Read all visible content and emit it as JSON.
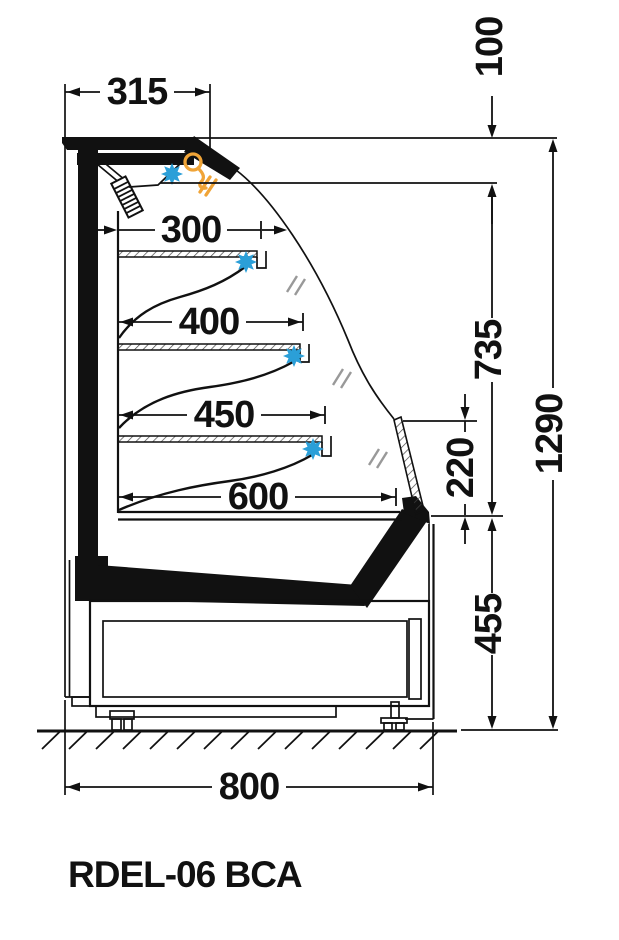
{
  "title": "RDEL-06 BCA",
  "drawing": {
    "type": "refrigerated display cabinet side-section technical drawing",
    "units": "mm"
  },
  "dims": {
    "d315": "315",
    "d100": "100",
    "d300": "300",
    "d400": "400",
    "d450": "450",
    "d600": "600",
    "d735": "735",
    "d220": "220",
    "d1290": "1290",
    "d455": "455",
    "d800": "800"
  },
  "dimensions": {
    "horizontal": [
      {
        "id": "canopy-depth",
        "label": "315"
      },
      {
        "id": "top-shelf-depth",
        "label": "300"
      },
      {
        "id": "middle-shelf-depth",
        "label": "400"
      },
      {
        "id": "lower-shelf-depth",
        "label": "450"
      },
      {
        "id": "base-deck-depth",
        "label": "600"
      },
      {
        "id": "overall-depth",
        "label": "800"
      }
    ],
    "vertical": [
      {
        "id": "canopy-height",
        "label": "100"
      },
      {
        "id": "display-opening-height",
        "label": "735"
      },
      {
        "id": "front-edge-height",
        "label": "220"
      },
      {
        "id": "base-height",
        "label": "455"
      },
      {
        "id": "overall-height",
        "label": "1290"
      }
    ]
  },
  "symbols": {
    "fan": {
      "icon": "fan-icon",
      "color": "#2B9FD8",
      "count": 4
    },
    "lamp": {
      "icon": "lamp-icon",
      "color": "#F0A437",
      "count": 1
    }
  },
  "colors": {
    "line": "#111111",
    "fan_blue": "#2B9FD8",
    "lamp_orange": "#F0A437",
    "background": "#ffffff"
  }
}
